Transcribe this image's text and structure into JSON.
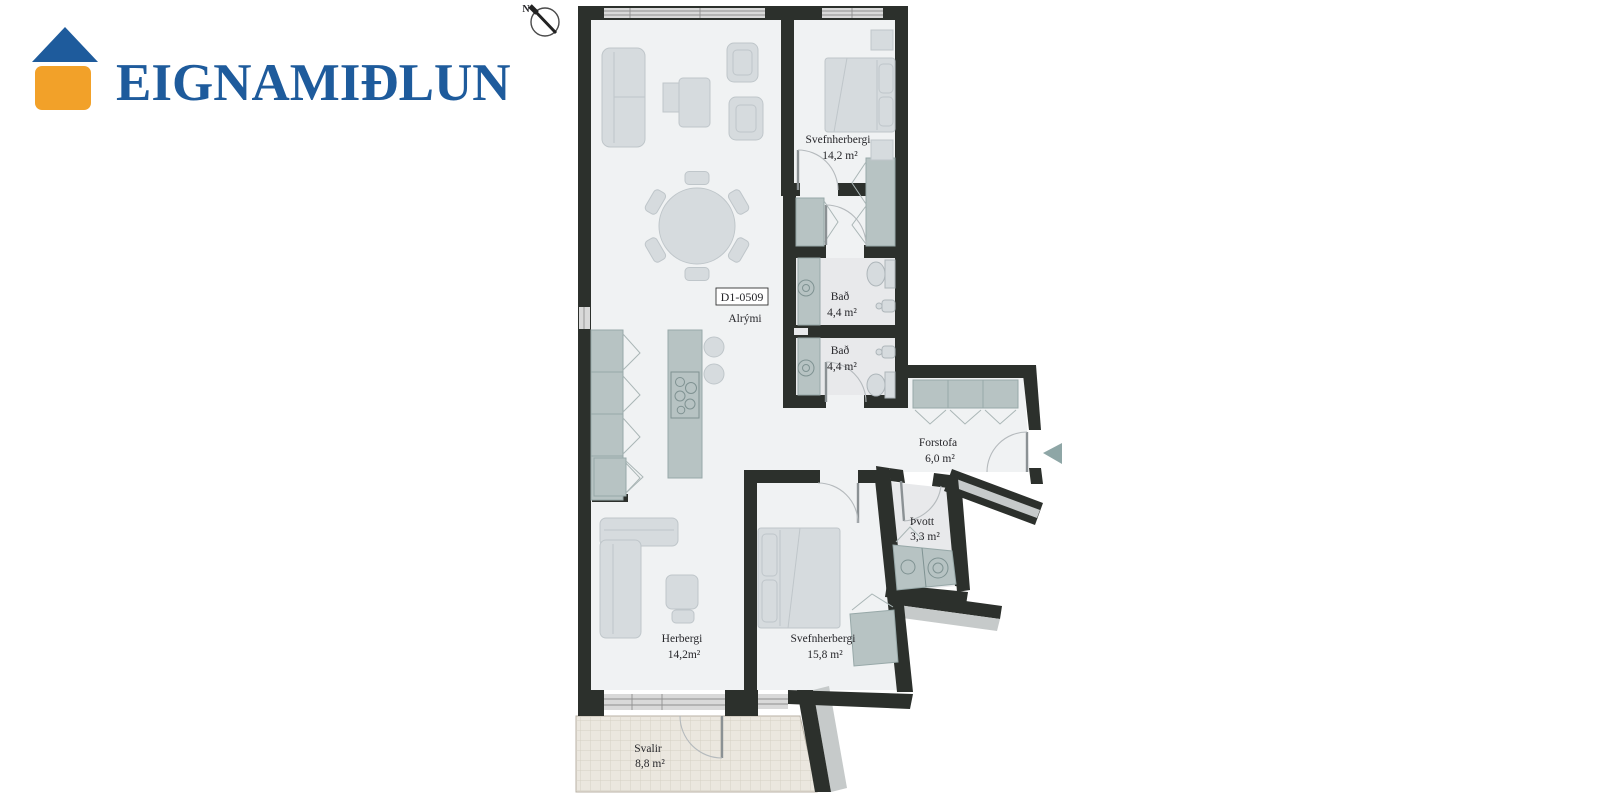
{
  "page": {
    "background": "#ffffff"
  },
  "logo": {
    "brand": "EIGNAMIÐLUN",
    "icon": "house-icon",
    "roof_color": "#1e5b9c",
    "body_color": "#f2a129",
    "text_color": "#1e5b9c"
  },
  "compass": {
    "label": "N"
  },
  "floorplan": {
    "unit_label": "D1-0509",
    "colors": {
      "wall": "#2c302c",
      "floor": "#f0f2f3",
      "wet_floor": "#e8e9eb",
      "furniture": "#d6dbde",
      "fixture": "#b7c3c3",
      "balcony_floor": "#ebe7df",
      "neighbor_wall": "#c6caca",
      "glass": "#d9d9d9",
      "entrance_arrow": "#8ea6a6"
    },
    "rooms": {
      "alrymi": {
        "name": "Alrými"
      },
      "svefnherbergi1": {
        "name": "Svefnherbergi",
        "area": "14,2 m²"
      },
      "bad1": {
        "name": "Bað",
        "area": "4,4 m²"
      },
      "bad2": {
        "name": "Bað",
        "area": "4,4 m²"
      },
      "forstofa": {
        "name": "Forstofa",
        "area": "6,0 m²"
      },
      "tvott": {
        "name": "Þvott",
        "area": "3,3 m²"
      },
      "herbergi": {
        "name": "Herbergi",
        "area": "14,2m²"
      },
      "svefnherbergi2": {
        "name": "Svefnherbergi",
        "area": "15,8 m²"
      },
      "svalir": {
        "name": "Svalir",
        "area": "8,8 m²"
      }
    }
  }
}
